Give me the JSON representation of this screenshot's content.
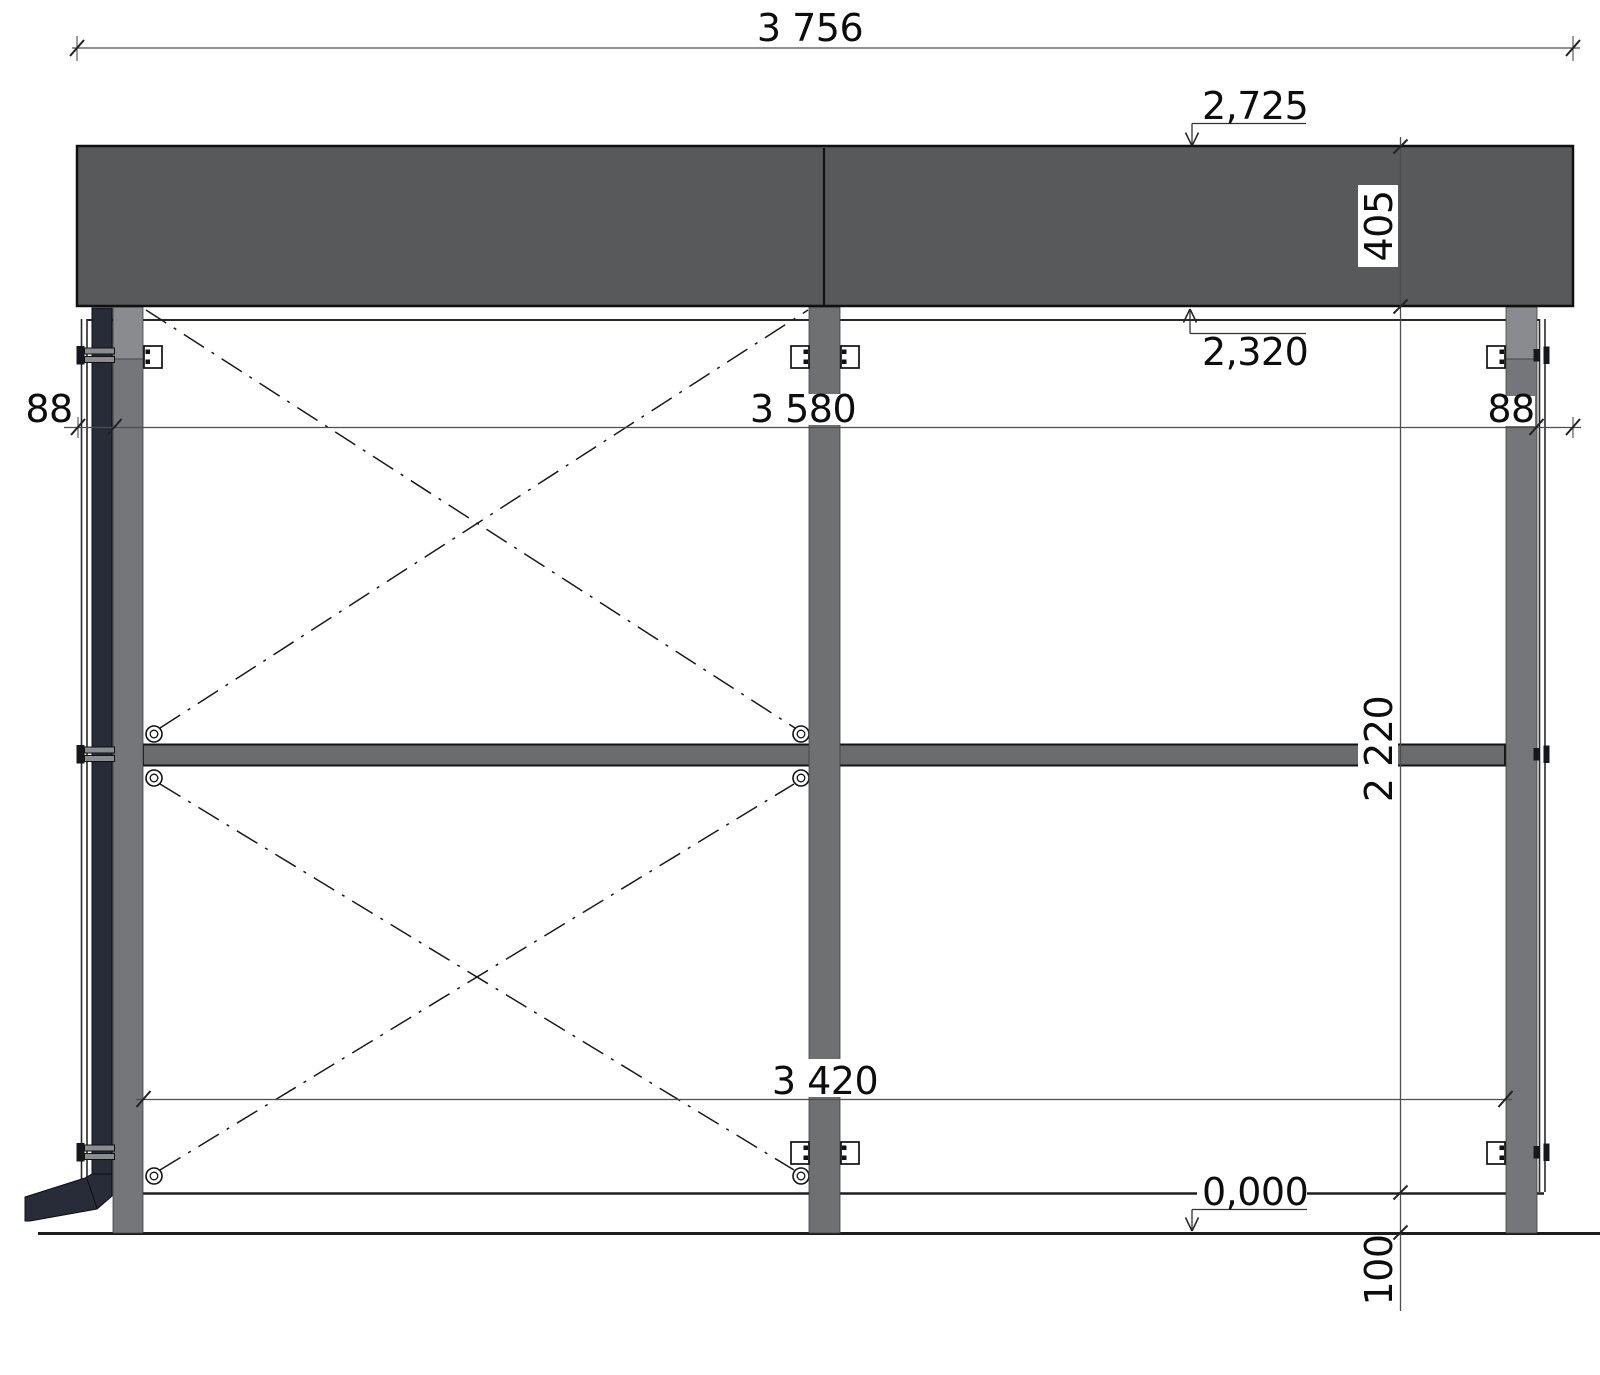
{
  "labels": {
    "overall_width": "3 756",
    "level_top": "2,725",
    "fascia_height": "405",
    "level_fascia_bottom": "2,320",
    "left_offset": "88",
    "inner_width": "3 580",
    "right_offset": "88",
    "frame_height": "2 220",
    "clear_width": "3 420",
    "level_ground": "0,000",
    "plinth_height": "100"
  },
  "colors": {
    "fascia": "#58595b",
    "post": "#757679",
    "post_cap": "#8a8b8e",
    "center_post": "#6f7072",
    "rail": "#6b6c6e",
    "downspout": "#282c39",
    "outline": "#111111",
    "dimension_line": "#4d4d4d",
    "text": "#0d0d0d",
    "background": "#ffffff"
  }
}
